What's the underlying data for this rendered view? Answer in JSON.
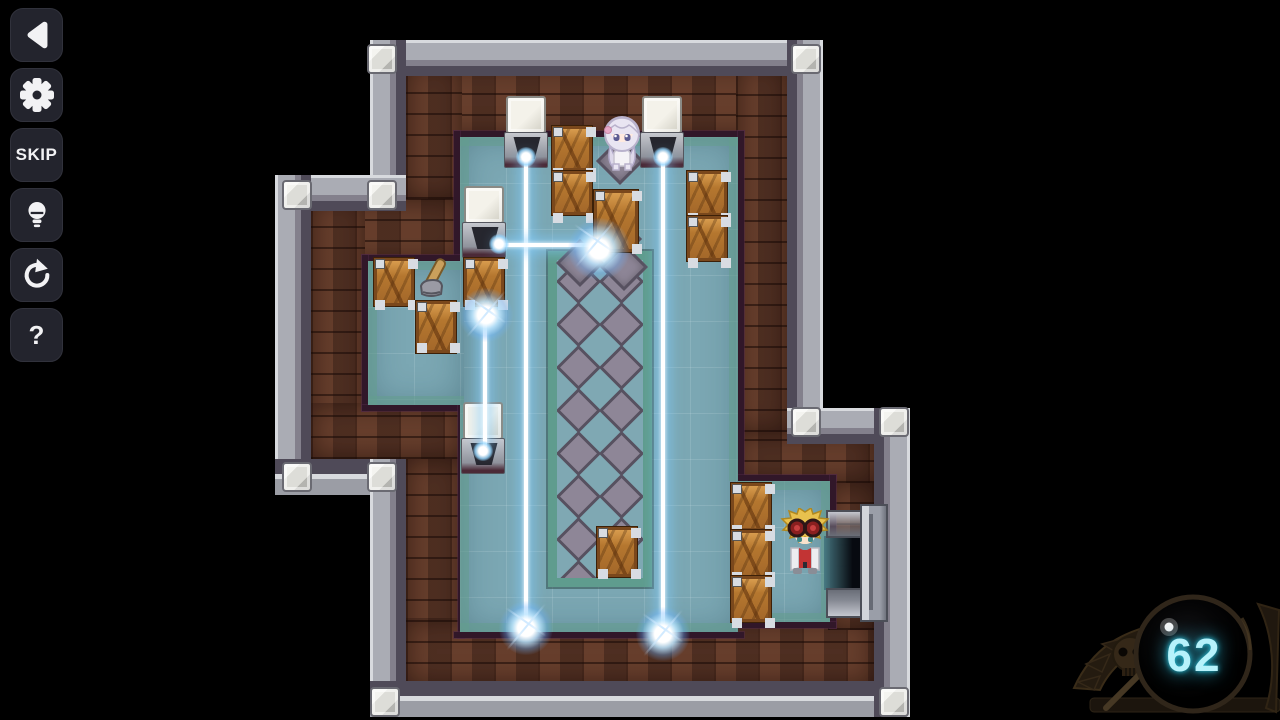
{
  "app": {
    "type": "top-down laser puzzle game",
    "background_color": "#000000"
  },
  "sidebar": {
    "buttons": [
      {
        "id": "back",
        "icon": "back-arrow-icon",
        "label": ""
      },
      {
        "id": "settings",
        "icon": "gear-icon",
        "label": ""
      },
      {
        "id": "skip",
        "icon": "",
        "label": "SKIP"
      },
      {
        "id": "hint",
        "icon": "lightbulb-icon",
        "label": ""
      },
      {
        "id": "restart",
        "icon": "restart-arrow-icon",
        "label": ""
      },
      {
        "id": "help",
        "icon": "",
        "label": "?"
      }
    ]
  },
  "hud": {
    "hint_counter": {
      "value": "62",
      "emblem_icon": "skull-sword-emblem",
      "text_color": "#b6f2fb"
    }
  },
  "scene": {
    "characters": [
      {
        "id": "silver-haired-girl",
        "location": "top-center of room"
      },
      {
        "id": "blonde-goggles-character",
        "location": "bottom-right beside exit door"
      }
    ],
    "items": [
      {
        "id": "hammer",
        "location": "left alcove floor"
      }
    ],
    "objects": {
      "wooden_crates": 12,
      "laser_emitters": 4,
      "laser_beams": 4,
      "impact_sparks": 4,
      "exit_door": 1,
      "stone_diamond_platform": 1
    },
    "colors": {
      "floor": "#7ba7b3",
      "brick_wall": "#5b3627",
      "stone_band": "#a2a4ae",
      "platform_border": "#5f9c8e",
      "diamond_tile": "#8d8596",
      "laser_glow": "#9ed4ff",
      "crate_wood": "#b5772f",
      "counter_glow": "#1fb7d8"
    }
  }
}
